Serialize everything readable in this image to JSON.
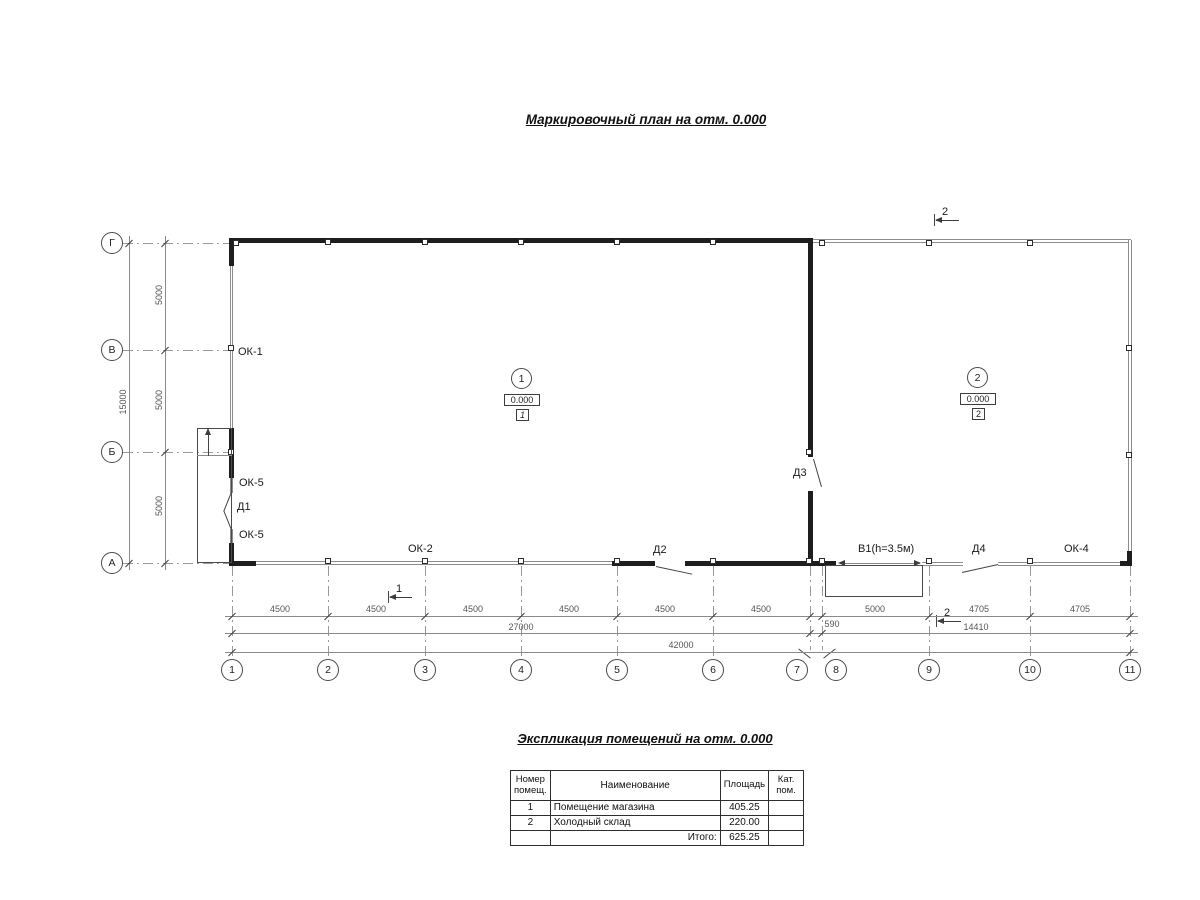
{
  "title": "Маркировочный план  на отм. 0.000",
  "plan": {
    "rows": [
      "Г",
      "В",
      "Б",
      "А"
    ],
    "cols": [
      "1",
      "2",
      "3",
      "4",
      "5",
      "6",
      "7",
      "8",
      "9",
      "10",
      "11"
    ],
    "dims": {
      "left": [
        "5000",
        "5000",
        "5000"
      ],
      "left_total": "15000",
      "bottom1": [
        "4500",
        "4500",
        "4500",
        "4500",
        "4500",
        "4500",
        "5000",
        "4705",
        "4705"
      ],
      "b590": "590",
      "bottom2": [
        "27000",
        "14410"
      ],
      "bottom3": "42000"
    },
    "openings": {
      "ok1": "ОК-1",
      "ok5": "ОК-5",
      "d1": "Д1",
      "ok2": "ОК-2",
      "d2": "Д2",
      "d3": "Д3",
      "v1": "В1(h=3.5м)",
      "d4": "Д4",
      "ok4": "ОК-4"
    },
    "sections": {
      "s1": "1",
      "s2": "2"
    },
    "rooms": [
      {
        "num": "1",
        "elev": "0.000",
        "tag": "1"
      },
      {
        "num": "2",
        "elev": "0.000",
        "tag": "2"
      }
    ]
  },
  "table": {
    "title": "Экспликация помещений на отм. 0.000",
    "headers": [
      "Номер помещ.",
      "Наименование",
      "Площадь",
      "Кат. пом."
    ],
    "rows": [
      {
        "num": "1",
        "name": "Помещение магазина",
        "area": "405.25",
        "cat": ""
      },
      {
        "num": "2",
        "name": "Холодный склад",
        "area": "220.00",
        "cat": ""
      }
    ],
    "total_label": "Итого:",
    "total": "625.25"
  }
}
